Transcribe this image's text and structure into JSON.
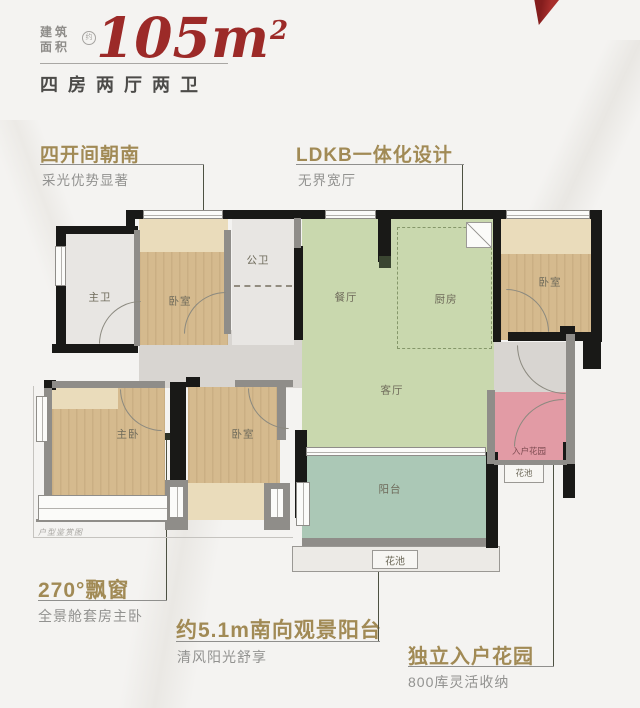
{
  "header": {
    "area_label_line1": "建筑",
    "area_label_line2": "面积",
    "area_circle_char": "约",
    "area_value": "105",
    "area_unit": "m",
    "area_sup": "2",
    "subtitle": "四房两厅两卫"
  },
  "annotations": {
    "a1": {
      "title": "四开间朝南",
      "subtitle": "采光优势显著"
    },
    "a2": {
      "title": "LDKB一体化设计",
      "subtitle": "无界宽厅"
    },
    "a3": {
      "title": "270°飘窗",
      "subtitle": "全景舱套房主卧"
    },
    "a4": {
      "title": "约5.1m南向观景阳台",
      "subtitle": "清风阳光舒享"
    },
    "a5": {
      "title": "独立入户花园",
      "subtitle": "800库灵活收纳"
    }
  },
  "floorplan": {
    "caption": "户型鉴赏图",
    "rooms": {
      "master_bath": "主卫",
      "bedroom_tl": "卧室",
      "public_bath": "公卫",
      "dining": "餐厅",
      "kitchen": "厨房",
      "bedroom_tr": "卧室",
      "living": "客厅",
      "master_bedroom": "主卧",
      "bedroom_bottom": "卧室",
      "balcony": "阳台",
      "entry_garden": "入户花园",
      "flower_bed_right": "花池",
      "flower_bed_bottom": "花池"
    }
  },
  "colors": {
    "brand_red": "#9c2a28",
    "accent_gold": "#a18a55",
    "wall_black": "#191917",
    "wall_gray": "#8f8d89",
    "floor_wood": "#d5ba8e",
    "floor_green": "#c9d8ae",
    "floor_teal": "#abc8b6",
    "floor_pink": "#e29ba5"
  }
}
